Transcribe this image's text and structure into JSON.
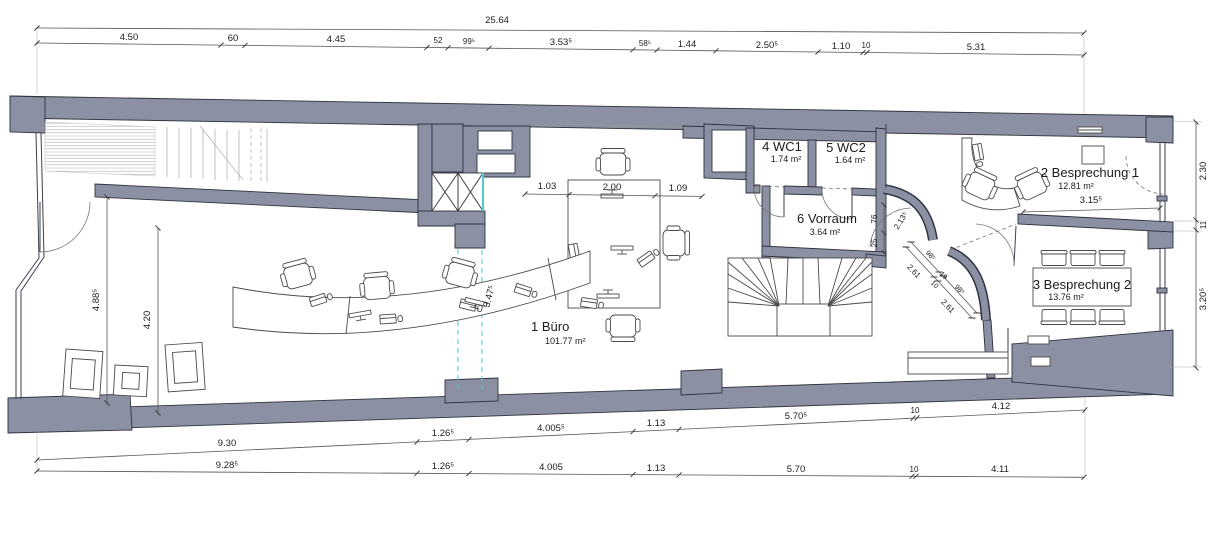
{
  "drawing": {
    "type": "architectural floor plan",
    "rooms": [
      {
        "label": "1 Büro",
        "area": "101.77 m²"
      },
      {
        "label": "2 Besprechung 1",
        "area": "12.81 m²"
      },
      {
        "label": "3 Besprechung 2",
        "area": "13.76 m²"
      },
      {
        "label": "4 WC1",
        "area": "1.74 m²"
      },
      {
        "label": "5 WC2",
        "area": "1.64 m²"
      },
      {
        "label": "6 Vorraum",
        "area": "3.64 m²"
      }
    ],
    "dims": {
      "top_total": "25.64",
      "top_chain": [
        "4.50",
        "60",
        "4.45",
        "52",
        "99⁵",
        "3.53⁵",
        "58⁵",
        "1.44",
        "2.50⁵",
        "1.10",
        "10",
        "5.31"
      ],
      "interior_table": [
        "1.03",
        "2.00",
        "1.09"
      ],
      "left": [
        "4.88⁵",
        "4.20"
      ],
      "right": [
        "2.30",
        "11",
        "3.20⁵"
      ],
      "besprechung1_width": "3.15⁵",
      "desk_diagonal": "3.47⁵",
      "stair_side": [
        "76",
        "25",
        "2.13⁵"
      ],
      "diag_chain": [
        "2.61",
        "98⁵",
        "19",
        "10",
        "98⁵",
        "2.61"
      ],
      "bottom_upper": [
        "9.30",
        "1.26⁵",
        "4.005⁵",
        "1.13",
        "5.70⁵",
        "10",
        "4.12"
      ],
      "bottom_lower": [
        "9.28⁵",
        "1.26⁵",
        "4.005",
        "1.13",
        "5.70",
        "10",
        "4.11"
      ]
    },
    "colors": {
      "wall": "#8b91a3",
      "outline": "#2e3340",
      "accent": "#5bc6cd",
      "dim_line": "#555555",
      "text": "#1b1b1b"
    }
  }
}
